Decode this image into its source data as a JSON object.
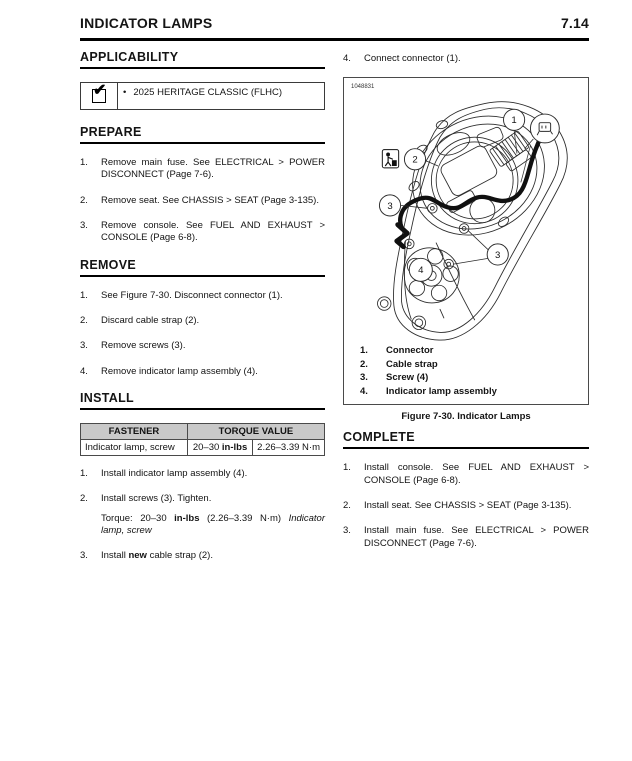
{
  "page": {
    "title": "INDICATOR LAMPS",
    "number": "7.14"
  },
  "applicability": {
    "heading": "APPLICABILITY",
    "checkmark": "✔",
    "bullet": "•",
    "model": "2025 HERITAGE CLASSIC (FLHC)"
  },
  "prepare": {
    "heading": "PREPARE",
    "steps": [
      {
        "num": "1.",
        "text": "Remove main fuse. See ELECTRICAL > POWER DISCONNECT (Page 7-6)."
      },
      {
        "num": "2.",
        "text": "Remove seat. See CHASSIS > SEAT (Page 3-135)."
      },
      {
        "num": "3.",
        "text": "Remove console. See FUEL AND EXHAUST > CONSOLE (Page 6-8)."
      }
    ]
  },
  "remove": {
    "heading": "REMOVE",
    "steps": [
      {
        "num": "1.",
        "text": "See Figure 7-30. Disconnect connector (1)."
      },
      {
        "num": "2.",
        "text": "Discard cable strap (2)."
      },
      {
        "num": "3.",
        "text": "Remove screws (3)."
      },
      {
        "num": "4.",
        "text": "Remove indicator lamp assembly (4)."
      }
    ]
  },
  "install": {
    "heading": "INSTALL",
    "table": {
      "col_fastener": "FASTENER",
      "col_torque": "TORQUE VALUE",
      "row": {
        "fastener": "Indicator lamp, screw",
        "inlbs_prefix": "20–30 ",
        "inlbs_bold": "in-lbs",
        "nm": "2.26–3.39 N·m"
      }
    },
    "steps": [
      {
        "num": "1.",
        "text": "Install indicator lamp assembly (4)."
      },
      {
        "num": "2.",
        "text": "Install screws (3). Tighten.",
        "torque_prefix": "Torque: 20–30 ",
        "torque_bold": "in-lbs",
        "torque_mid": " (2.26–3.39 N·m) ",
        "torque_italic": "Indicator lamp, screw"
      },
      {
        "num": "3.",
        "prefix": "Install ",
        "bold": "new",
        "suffix": " cable strap (2)."
      }
    ]
  },
  "figure": {
    "pre_step": {
      "num": "4.",
      "text": "Connect connector (1)."
    },
    "ref_number": "1048831",
    "callouts": [
      "1",
      "2",
      "3",
      "3",
      "4"
    ],
    "legend": [
      {
        "num": "1.",
        "label": "Connector"
      },
      {
        "num": "2.",
        "label": "Cable strap"
      },
      {
        "num": "3.",
        "label": "Screw (4)"
      },
      {
        "num": "4.",
        "label": "Indicator lamp assembly"
      }
    ],
    "caption": "Figure 7-30. Indicator Lamps"
  },
  "complete": {
    "heading": "COMPLETE",
    "steps": [
      {
        "num": "1.",
        "text": "Install console. See FUEL AND EXHAUST > CONSOLE (Page 6-8)."
      },
      {
        "num": "2.",
        "text": "Install seat. See CHASSIS > SEAT (Page 3-135)."
      },
      {
        "num": "3.",
        "text": "Install main fuse. See ELECTRICAL > POWER DISCONNECT (Page 7-6)."
      }
    ]
  },
  "colors": {
    "table_header_bg": "#c9c9c9",
    "rule": "#000000",
    "border": "#4a4a4a"
  }
}
